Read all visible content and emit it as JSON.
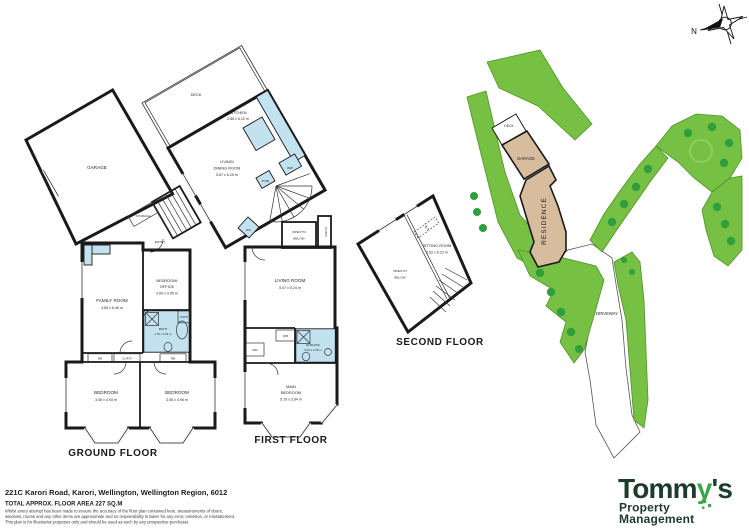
{
  "colors": {
    "wall": "#1a1a1a",
    "wet_area": "#c3e2ef",
    "lawn_green": "#76c043",
    "shrub_green": "#2f9e3d",
    "building_tan": "#d7bc9e",
    "logo_dark_green": "#1b3b2d",
    "logo_key_green": "#3aa54a"
  },
  "compass": {
    "north": "N"
  },
  "ground_floor": {
    "title": "GROUND FLOOR",
    "garage": "GARAGE",
    "storage": "STORAGE",
    "entry": "ENTRY",
    "family_room": "FAMILY ROOM",
    "family_room_dims": "3.85 x 6.46 m",
    "bedroom_office_1": "BEDROOM/",
    "bedroom_office_2": "OFFICE",
    "bedroom_office_dims": "2.69 x 3.05 m",
    "bath": "BATH",
    "bath_dims": "1.76 x 2.51 m",
    "cupboard_bath": "CUP'D",
    "robe_left": "RB",
    "cupboard_hall": "CUP'D",
    "robe_right": "RB",
    "bedroom_left": "BEDROOM",
    "bedroom_left_dims": "3.06 x 4.93 m",
    "bedroom_right": "BEDROOM",
    "bedroom_right_dims": "3.06 x 4.96 m"
  },
  "first_floor": {
    "title": "FIRST FLOOR",
    "deck": "DECK",
    "kitchen": "KITCHEN",
    "kitchen_dims": "2.88 x 6.22 m",
    "living_dining_1": "LIVING/",
    "living_dining_2": "DINING ROOM",
    "living_dining_dims": "5.67 x 6.25 m",
    "wip": "WIP",
    "powder": "P'DR",
    "wc": "WC",
    "open_below_1": "OPEN TO",
    "open_below_2": "BELOW",
    "cupboard": "CUP'D",
    "living_room": "LIVING ROOM",
    "living_room_dims": "5.07 x 5.24 m",
    "wardrobe_a": "WR",
    "wardrobe_b": "WR",
    "ensuite": "ENSUITE",
    "ensuite_dims": "3.03 x 2.26 m",
    "main_bedroom_1": "MAIN",
    "main_bedroom_2": "BEDROOM",
    "main_bedroom_dims": "5.10 x 3.84 m"
  },
  "second_floor": {
    "title": "SECOND FLOOR",
    "open_below_1": "OPEN TO",
    "open_below_2": "BELOW",
    "sitting_room": "SITTING ROOM",
    "sitting_room_dims": "2.62 x 6.22 m"
  },
  "site_plan": {
    "deck": "DECK",
    "garage": "GARAGE",
    "residence": "RESIDENCE",
    "driveway": "DRIVEWAY"
  },
  "footer": {
    "address": "221C Karori Road, Karori, Wellington, Wellington Region, 6012",
    "floor_area": "TOTAL APPROX. FLOOR AREA 227 SQ.M",
    "disclaimer_1": "Whilst every attempt has been made to ensure the accuracy of the floor plan contained here, measurements of doors,",
    "disclaimer_2": "windows, rooms and any other items are approximate and no responsibility is taken for any error, omission, or misstatement.",
    "disclaimer_3": "This plan is for illustrative purposes only and should be used as such by any prospective purchaser."
  },
  "logo": {
    "brand_pre": "Tomm",
    "brand_key": "y",
    "brand_post": "'s",
    "subtitle_1": "Property",
    "subtitle_2": "Management"
  }
}
